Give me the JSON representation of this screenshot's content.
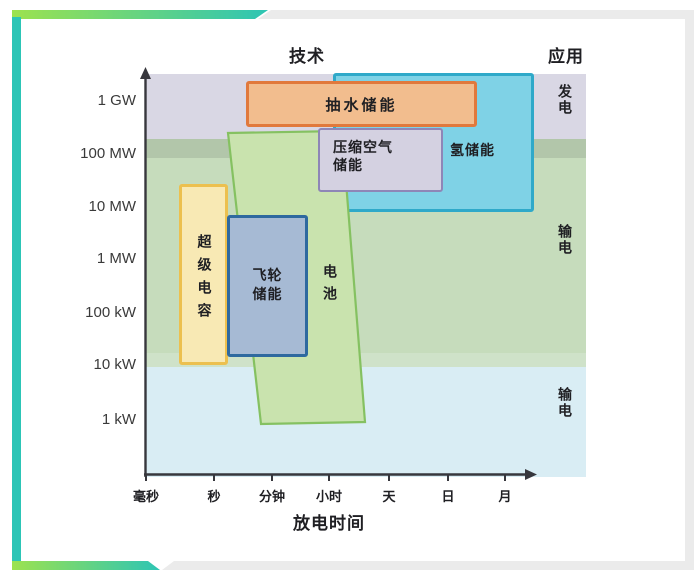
{
  "frame": {
    "gradient_start": "#9ce24f",
    "gradient_end": "#2ec5b4",
    "left_bar_color": "#2cc5b6",
    "gray_strip_color": "#ebebeb"
  },
  "chart_data": {
    "type": "area",
    "title_technology": "技术",
    "title_application": "应用",
    "xlabel": "放电时间",
    "ylabel": "",
    "x_ticks": [
      "毫秒",
      "秒",
      "分钟",
      "小时",
      "天",
      "日",
      "月"
    ],
    "y_ticks": [
      "1 GW",
      "100 MW",
      "10 MW",
      "1 MW",
      "100 kW",
      "10 kW",
      "1 kW"
    ],
    "y_scale": "log",
    "layout": {
      "axis_color": "#37373d",
      "text_color": "#1f1f23",
      "grid": false,
      "legend": false,
      "y_axis_arrow": "up",
      "x_axis_arrow": "right"
    },
    "application_bands": [
      {
        "label": "发电",
        "color": "#d9d7e4",
        "power_range": [
          "100 MW",
          ">1 GW"
        ]
      },
      {
        "label": "",
        "color": "#b2c6aa",
        "power_range": [
          "100 MW",
          "100 MW"
        ]
      },
      {
        "label": "输电",
        "color": "#c6dcbc",
        "power_range": [
          "10 kW",
          "100 MW"
        ]
      },
      {
        "label": "",
        "color": "#cfe2c9",
        "power_range": [
          "10 kW",
          "10 kW"
        ]
      },
      {
        "label": "输电",
        "color": "#d9edf4",
        "power_range": [
          "<1 kW",
          "10 kW"
        ]
      }
    ],
    "regions": [
      {
        "id": "pumped-hydro",
        "label": "抽水储能",
        "fill": "#f2bd8e",
        "border": "#e1793c",
        "discharge_time": [
          "分钟",
          "日–月"
        ],
        "power": [
          "~300 MW",
          "~2.5 GW"
        ]
      },
      {
        "id": "caes",
        "label": "压缩空气储能",
        "label_display": "压缩空气\n储能",
        "fill": "#d4d1e1",
        "border": "#8e86b7",
        "discharge_time": [
          "小时",
          "日"
        ],
        "power": [
          "~20 MW",
          "~300 MW"
        ]
      },
      {
        "id": "hydrogen",
        "label": "氢储能",
        "fill": "#7fd2e6",
        "border": "#2fa9c9",
        "discharge_time": [
          "小时",
          ">月"
        ],
        "power": [
          "~8 MW",
          "~3 GW"
        ]
      },
      {
        "id": "supercapacitor",
        "label": "超级电容",
        "fill": "#f8e9b4",
        "border": "#ecc04f",
        "discharge_time": [
          "毫秒",
          "秒"
        ],
        "power": [
          "~10 kW",
          "~30 MW"
        ]
      },
      {
        "id": "flywheel",
        "label": "飞轮储能",
        "label_display": "飞轮\n储能",
        "fill": "#a6bad4",
        "border": "#2e699f",
        "discharge_time": [
          "秒",
          "分钟–小时"
        ],
        "power": [
          "~15 kW",
          "~7 MW"
        ]
      },
      {
        "id": "battery",
        "label": "电池",
        "fill": "#c9e3ae",
        "border": "#85c161",
        "discharge_time": [
          "秒",
          "小时–天"
        ],
        "power": [
          "~1 kW",
          "~300 MW"
        ]
      }
    ]
  }
}
